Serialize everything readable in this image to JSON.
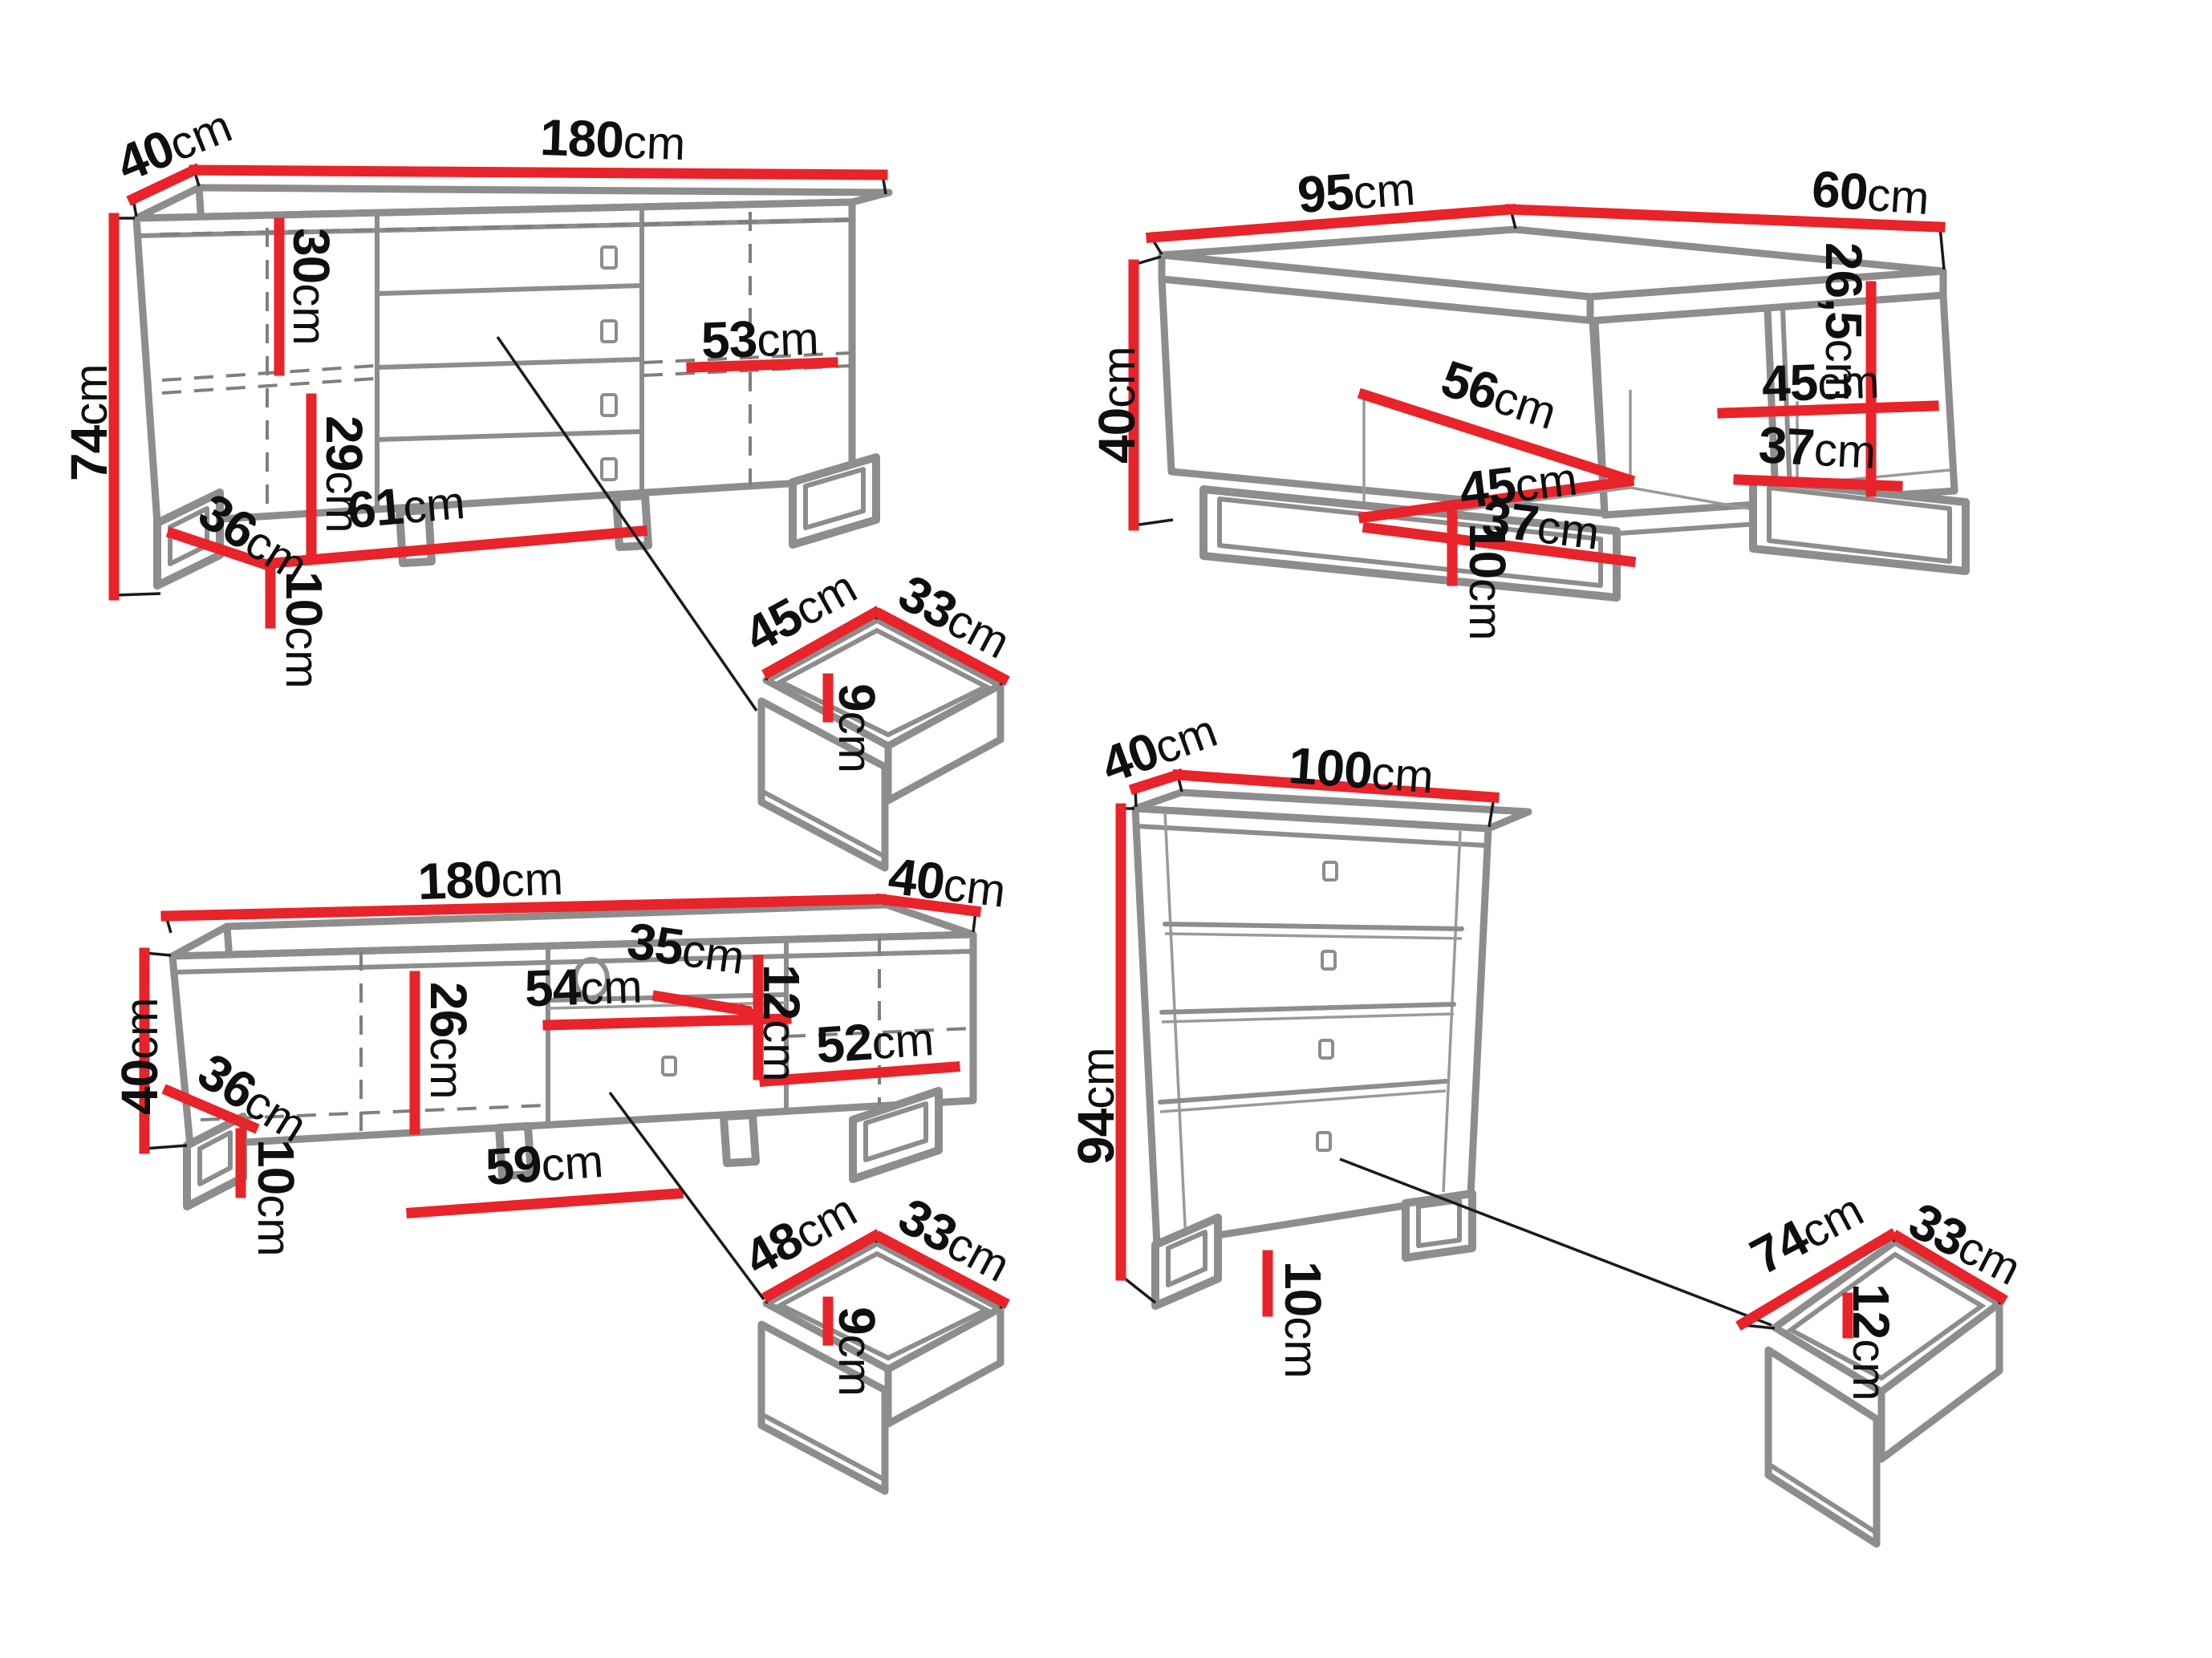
{
  "colors": {
    "dimension_red": "#e82329",
    "outline_gray": "#8d8d8d",
    "label_black": "#0f0f0f",
    "background": "#ffffff"
  },
  "pieces": {
    "sideboard": {
      "name": "sideboard",
      "width": {
        "v": "180",
        "u": "cm"
      },
      "depth": {
        "v": "40",
        "u": "cm"
      },
      "height": {
        "v": "74",
        "u": "cm"
      },
      "upper_inner_height": {
        "v": "30",
        "u": "cm"
      },
      "lower_inner_height": {
        "v": "29",
        "u": "cm"
      },
      "inner_width": {
        "v": "61",
        "u": "cm"
      },
      "bottom_side_depth": {
        "v": "36",
        "u": "cm"
      },
      "leg_height": {
        "v": "10",
        "u": "cm"
      },
      "right_inner_width": {
        "v": "53",
        "u": "cm"
      },
      "drawer": {
        "width": {
          "v": "45",
          "u": "cm"
        },
        "depth": {
          "v": "33",
          "u": "cm"
        },
        "inner_height": {
          "v": "9",
          "u": "cm"
        }
      }
    },
    "coffee_table": {
      "name": "coffee table",
      "width": {
        "v": "95",
        "u": "cm"
      },
      "depth": {
        "v": "60",
        "u": "cm"
      },
      "height": {
        "v": "40",
        "u": "cm"
      },
      "left_shelf_diagonal": {
        "v": "56",
        "u": "cm"
      },
      "left_inner_width": {
        "v": "45",
        "u": "cm"
      },
      "left_shelf_depth": {
        "v": "37",
        "u": "cm"
      },
      "right_inner_width": {
        "v": "45",
        "u": "cm"
      },
      "right_shelf_depth": {
        "v": "37",
        "u": "cm"
      },
      "inner_height": {
        "v": "26,5",
        "u": "cm"
      },
      "leg_height": {
        "v": "10",
        "u": "cm"
      }
    },
    "tv_stand": {
      "name": "TV stand",
      "width": {
        "v": "180",
        "u": "cm"
      },
      "depth": {
        "v": "40",
        "u": "cm"
      },
      "height": {
        "v": "40",
        "u": "cm"
      },
      "bottom_side_depth": {
        "v": "36",
        "u": "cm"
      },
      "inner_height": {
        "v": "26",
        "u": "cm"
      },
      "left_inner_width": {
        "v": "59",
        "u": "cm"
      },
      "shelf_depth": {
        "v": "54",
        "u": "cm"
      },
      "niche_width": {
        "v": "35",
        "u": "cm"
      },
      "drawer_inner_height": {
        "v": "12",
        "u": "cm"
      },
      "right_inner_width": {
        "v": "52",
        "u": "cm"
      },
      "leg_height": {
        "v": "10",
        "u": "cm"
      },
      "drawer": {
        "width": {
          "v": "48",
          "u": "cm"
        },
        "depth": {
          "v": "33",
          "u": "cm"
        },
        "inner_height": {
          "v": "9",
          "u": "cm"
        }
      }
    },
    "chest": {
      "name": "chest of drawers",
      "width": {
        "v": "100",
        "u": "cm"
      },
      "depth": {
        "v": "40",
        "u": "cm"
      },
      "height": {
        "v": "94",
        "u": "cm"
      },
      "leg_height": {
        "v": "10",
        "u": "cm"
      },
      "drawer": {
        "width": {
          "v": "74",
          "u": "cm"
        },
        "depth": {
          "v": "33",
          "u": "cm"
        },
        "inner_height": {
          "v": "12",
          "u": "cm"
        }
      }
    }
  }
}
